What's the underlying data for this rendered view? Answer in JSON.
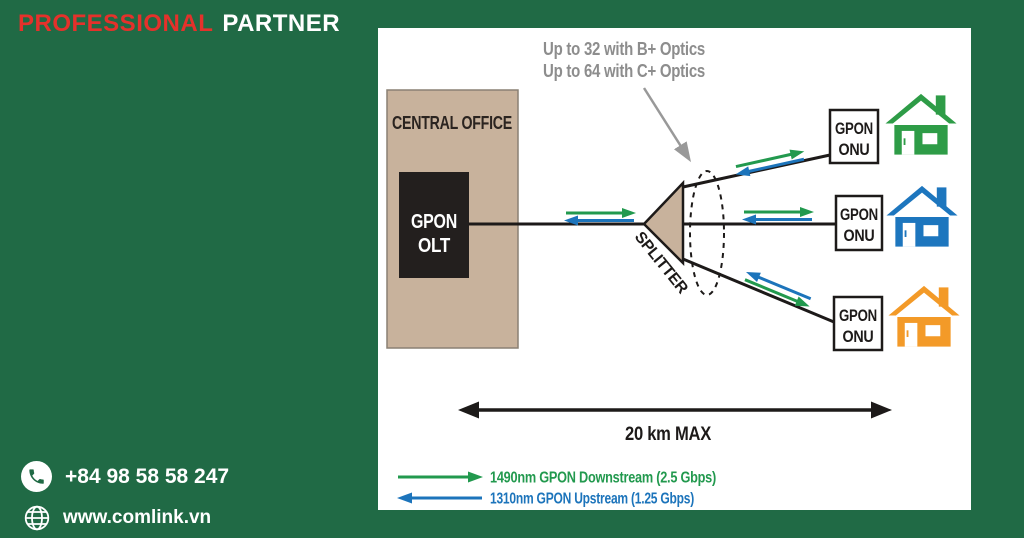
{
  "brand": {
    "word1": "PROFESSIONAL",
    "word2": "PARTNER"
  },
  "contact": {
    "phone": "+84 98 58 58 247",
    "website": "www.comlink.vn"
  },
  "diagram": {
    "annotation": {
      "line1": "Up to 32 with B+ Optics",
      "line2": "Up to 64 with C+ Optics"
    },
    "central_office_label": "CENTRAL OFFICE",
    "olt": {
      "line1": "GPON",
      "line2": "OLT"
    },
    "splitter_label": "SPLITTER",
    "onu": {
      "line1": "GPON",
      "line2": "ONU"
    },
    "distance_label": "20 km MAX",
    "legend": {
      "downstream": "1490nm GPON Downstream (2.5 Gbps)",
      "upstream": "1310nm GPON Upstream (1.25 Gbps)"
    }
  },
  "colors": {
    "background_green": "#206a45",
    "brand_red": "#e5312b",
    "downstream_green": "#22994e",
    "upstream_blue": "#1c74bb",
    "house_green": "#2e9c47",
    "house_blue": "#1d76be",
    "house_orange": "#f39a28",
    "central_office_tan": "#c8b29c",
    "annotation_gray": "#8d8d8d",
    "ink_black": "#1d1a19"
  }
}
